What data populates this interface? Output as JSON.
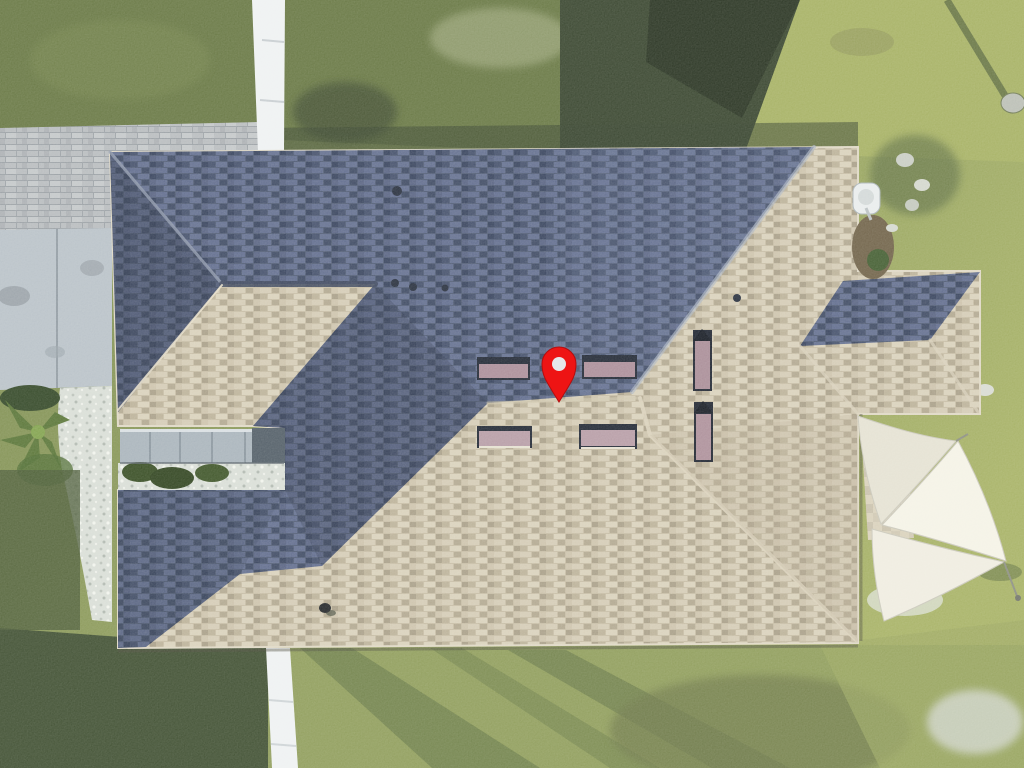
{
  "image": {
    "type": "aerial-drone-photo",
    "subject": "Top-down aerial drone view of a single-story house shingle roof marked with a red map location pin; lawn, paver walkway, concrete driveway, white fence, landscaping and white shade sails around the house",
    "width": 1024,
    "height": 768
  },
  "map_pin": {
    "x": 559,
    "y": 402,
    "meaning": "property-location-marker"
  },
  "features": {
    "skylight_count": 6,
    "roof_vent_count": 5,
    "shade_sail_count": 3,
    "satellite_dish_count": 1,
    "bird_on_roof": 1
  },
  "colors": {
    "pin": "#ee1414",
    "pin-edge": "#b30e0e",
    "pin-hole": "#e6e8ea",
    "roof-sun": "#c5bba3",
    "roof-shade": "#4c5872",
    "roof-cap-light": "#d9d0ba",
    "roof-cap-shade": "#9aa3b5",
    "grass-light": "#a5b062",
    "grass-mid": "#7b8b4c",
    "grass-olive": "#8d9b58",
    "grass-dark": "#34412a",
    "grass-shadow": "#3c4c2e",
    "concrete": "#b7c0c7",
    "paver": "#b6babd",
    "fence": "#eef1f2",
    "gravel": "#d8ddd6",
    "sail": "#efece0",
    "sail-bright": "#f4f2e6",
    "sail-dim": "#e4e1d2",
    "skylight-frame": "#1c2330",
    "skylight-glass": "#a98b97",
    "garage-band": "#a7b2ba",
    "garage-band-dark": "#4e5a64",
    "mulch": "#6d5f45",
    "shrub": "#33491f"
  }
}
